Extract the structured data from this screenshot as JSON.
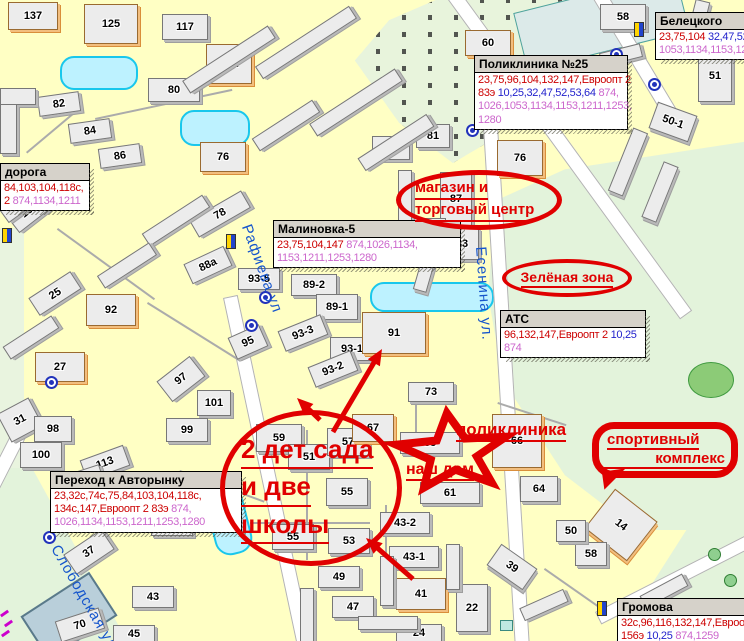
{
  "map": {
    "colors": {
      "route_red": "#CC0000",
      "route_blue": "#2222CC",
      "route_magenta": "#CC66CC",
      "annotation_red": "#E00000",
      "street_blue": "#1555CC"
    },
    "street_labels": [
      {
        "name": "street-rafieva",
        "text": "Рафиева ул",
        "x": 254,
        "y": 222,
        "rot": 70
      },
      {
        "name": "street-esenina",
        "text": "Есенина ул.",
        "x": 489,
        "y": 246,
        "rot": 86
      },
      {
        "name": "street-slobodskaya",
        "text": "Слободская ул",
        "x": 62,
        "y": 542,
        "rot": 60
      }
    ],
    "info_boxes": [
      {
        "title": "Белецкого",
        "x": 655,
        "y": 12,
        "w": 120,
        "lines": [
          [
            {
              "t": "23,75,104",
              "c": "r"
            },
            {
              "t": " 32,47,52,5",
              "c": "b"
            }
          ],
          [
            {
              "t": "1053,1134,1153,1211",
              "c": "m"
            }
          ]
        ]
      },
      {
        "title": "Поликлиника №25",
        "x": 474,
        "y": 55,
        "w": 152,
        "lines": [
          [
            {
              "t": "23,75,96,104,132,147,Евроопт 2",
              "c": "r"
            }
          ],
          [
            {
              "t": "83э",
              "c": "r"
            },
            {
              "t": " 10,25,32,47,52,53,64",
              "c": "b"
            },
            {
              "t": " 874,",
              "c": "m"
            }
          ],
          [
            {
              "t": "1026,1053,1134,1153,1211,1253,",
              "c": "m"
            }
          ],
          [
            {
              "t": "1280",
              "c": "m"
            }
          ]
        ]
      },
      {
        "title": "Малиновка-5",
        "x": 273,
        "y": 220,
        "w": 186,
        "lines": [
          [
            {
              "t": "23,75,104,147",
              "c": "r"
            },
            {
              "t": " 874,1026,1134,",
              "c": "m"
            }
          ],
          [
            {
              "t": "1153,1211,1253,1280",
              "c": "m"
            }
          ]
        ]
      },
      {
        "title": "АТС",
        "x": 500,
        "y": 310,
        "w": 144,
        "lines": [
          [
            {
              "t": "96,132,147,Евроопт 2",
              "c": "r"
            },
            {
              "t": " 10,25",
              "c": "b"
            }
          ],
          [
            {
              "t": "874",
              "c": "m"
            }
          ]
        ]
      },
      {
        "title": "дорога",
        "x": 0,
        "y": 163,
        "w": 88,
        "lines": [
          [
            {
              "t": "84,103,104,118с,",
              "c": "r"
            }
          ],
          [
            {
              "t": "2",
              "c": "r"
            },
            {
              "t": " 874,1134,1211",
              "c": "m"
            }
          ]
        ]
      },
      {
        "title": "Переход к Авторынку",
        "x": 50,
        "y": 471,
        "w": 190,
        "lines": [
          [
            {
              "t": "23,32с,74с,75,84,103,104,118с,",
              "c": "r"
            }
          ],
          [
            {
              "t": "134с,147,Евроопт 2  83э",
              "c": "r"
            },
            {
              "t": " 874,",
              "c": "m"
            }
          ],
          [
            {
              "t": "1026,1134,1153,1211,1253,1280",
              "c": "m"
            }
          ]
        ]
      },
      {
        "title": "Громова",
        "x": 617,
        "y": 598,
        "w": 130,
        "lines": [
          [
            {
              "t": "32с,96,116,132,147,Евроопт",
              "c": "r"
            }
          ],
          [
            {
              "t": "156э",
              "c": "r"
            },
            {
              "t": " 10,25",
              "c": "b"
            },
            {
              "t": " 874,1259",
              "c": "m"
            }
          ]
        ]
      }
    ],
    "annotations": {
      "ellipses": [
        {
          "name": "shop-area",
          "lines": [
            "магазин и",
            "торговый центр"
          ],
          "x": 396,
          "y": 170,
          "w": 166,
          "h": 60,
          "fs": 15,
          "pad": 14,
          "bw": 5,
          "center": false
        },
        {
          "name": "green-zone",
          "lines": [
            "Зелёная зона"
          ],
          "x": 502,
          "y": 259,
          "w": 130,
          "h": 38,
          "fs": 14,
          "pad": 0,
          "bw": 4,
          "center": true
        },
        {
          "name": "kindergartens-schools",
          "lines": [
            "2 дет сада",
            "и две",
            "школы"
          ],
          "x": 220,
          "y": 410,
          "w": 182,
          "h": 156,
          "fs": 26,
          "pad": 16,
          "bw": 5,
          "center": false
        }
      ],
      "labels": [
        {
          "name": "polyclinic",
          "text": "поликлиника",
          "x": 456,
          "y": 420,
          "fs": 17
        },
        {
          "name": "our-house",
          "text": "наш дом",
          "x": 406,
          "y": 460,
          "fs": 16
        }
      ],
      "bubble": {
        "name": "sports-complex",
        "lines": [
          "спортивный",
          "комплекс"
        ],
        "x": 592,
        "y": 422,
        "w": 146,
        "h": 56,
        "fs": 15
      },
      "star": {
        "cx": 453,
        "cy": 453,
        "rx": 58,
        "ry": 40,
        "inner": 0.42,
        "tilt": -6
      },
      "arrows": [
        {
          "x1": 333,
          "y1": 432,
          "x2": 382,
          "y2": 349
        },
        {
          "x1": 320,
          "y1": 420,
          "x2": 297,
          "y2": 398
        },
        {
          "x1": 413,
          "y1": 579,
          "x2": 366,
          "y2": 538
        }
      ]
    },
    "buildings": [
      {
        "l": "137",
        "x": 8,
        "y": 2,
        "w": 48,
        "h": 26,
        "o": 1
      },
      {
        "l": "125",
        "x": 84,
        "y": 4,
        "w": 52,
        "h": 38,
        "o": 1
      },
      {
        "l": "117",
        "x": 162,
        "y": 14,
        "w": 44,
        "h": 24
      },
      {
        "l": "82а",
        "x": 206,
        "y": 44,
        "w": 44,
        "h": 38,
        "o": 1
      },
      {
        "l": "80",
        "x": 148,
        "y": 78,
        "w": 50,
        "h": 22
      },
      {
        "l": "82",
        "x": 38,
        "y": 94,
        "w": 40,
        "h": 18,
        "r": -8
      },
      {
        "l": "84",
        "x": 69,
        "y": 121,
        "w": 40,
        "h": 18,
        "r": -8
      },
      {
        "l": "86",
        "x": 99,
        "y": 146,
        "w": 40,
        "h": 18,
        "r": -8
      },
      {
        "l": "76",
        "x": 200,
        "y": 142,
        "w": 44,
        "h": 28,
        "o": 1
      },
      {
        "l": "60",
        "x": 465,
        "y": 30,
        "w": 44,
        "h": 24,
        "o": 1
      },
      {
        "l": "58",
        "x": 600,
        "y": 4,
        "w": 44,
        "h": 24
      },
      {
        "l": "51",
        "x": 698,
        "y": 50,
        "w": 32,
        "h": 50
      },
      {
        "l": "50-1",
        "x": 652,
        "y": 108,
        "w": 40,
        "h": 26,
        "r": 20
      },
      {
        "l": "81",
        "x": 416,
        "y": 124,
        "w": 32,
        "h": 22
      },
      {
        "l": "81а",
        "x": 372,
        "y": 136,
        "w": 36,
        "h": 22
      },
      {
        "l": "76",
        "x": 497,
        "y": 140,
        "w": 44,
        "h": 34,
        "o": 1
      },
      {
        "l": "87",
        "x": 440,
        "y": 172,
        "w": 30,
        "h": 52
      },
      {
        "l": "85",
        "x": 412,
        "y": 218,
        "w": 32,
        "h": 22
      },
      {
        "l": "83",
        "x": 445,
        "y": 228,
        "w": 32,
        "h": 30
      },
      {
        "l": "78",
        "x": 190,
        "y": 204,
        "w": 58,
        "h": 18,
        "r": -30
      },
      {
        "l": "88а",
        "x": 186,
        "y": 254,
        "w": 42,
        "h": 20,
        "r": -25
      },
      {
        "l": "93-5",
        "x": 238,
        "y": 268,
        "w": 40,
        "h": 20
      },
      {
        "l": "89-2",
        "x": 291,
        "y": 274,
        "w": 44,
        "h": 20
      },
      {
        "l": "89-1",
        "x": 316,
        "y": 294,
        "w": 40,
        "h": 24
      },
      {
        "l": "93-3",
        "x": 280,
        "y": 322,
        "w": 44,
        "h": 20,
        "r": -22
      },
      {
        "l": "93-1",
        "x": 330,
        "y": 337,
        "w": 42,
        "h": 22
      },
      {
        "l": "93-2",
        "x": 310,
        "y": 358,
        "w": 44,
        "h": 20,
        "r": -22
      },
      {
        "l": "91",
        "x": 362,
        "y": 312,
        "w": 62,
        "h": 40,
        "o": 1
      },
      {
        "l": "95",
        "x": 231,
        "y": 330,
        "w": 32,
        "h": 22,
        "r": -24
      },
      {
        "l": "25",
        "x": 30,
        "y": 283,
        "w": 48,
        "h": 19,
        "r": -33
      },
      {
        "l": "92",
        "x": 86,
        "y": 294,
        "w": 48,
        "h": 30,
        "o": 1
      },
      {
        "l": "27",
        "x": 35,
        "y": 352,
        "w": 48,
        "h": 28,
        "o": 1
      },
      {
        "l": "31",
        "x": 2,
        "y": 404,
        "w": 34,
        "h": 30,
        "r": -28
      },
      {
        "l": "98",
        "x": 34,
        "y": 416,
        "w": 36,
        "h": 24
      },
      {
        "l": "100",
        "x": 20,
        "y": 442,
        "w": 40,
        "h": 24
      },
      {
        "l": "113",
        "x": 82,
        "y": 452,
        "w": 44,
        "h": 20,
        "r": -20
      },
      {
        "l": "97",
        "x": 160,
        "y": 366,
        "w": 40,
        "h": 24,
        "r": -38
      },
      {
        "l": "101",
        "x": 197,
        "y": 390,
        "w": 32,
        "h": 24
      },
      {
        "l": "99",
        "x": 166,
        "y": 418,
        "w": 40,
        "h": 22
      },
      {
        "l": "19",
        "x": 8,
        "y": 200,
        "w": 36,
        "h": 22,
        "r": -38
      },
      {
        "l": "37",
        "x": 66,
        "y": 540,
        "w": 44,
        "h": 22,
        "r": -34
      },
      {
        "l": "39",
        "x": 151,
        "y": 514,
        "w": 40,
        "h": 20
      },
      {
        "l": "43",
        "x": 132,
        "y": 586,
        "w": 40,
        "h": 20
      },
      {
        "l": "45",
        "x": 113,
        "y": 625,
        "w": 40,
        "h": 16
      },
      {
        "l": "70",
        "x": 57,
        "y": 614,
        "w": 44,
        "h": 20,
        "r": -18
      },
      {
        "l": "59",
        "x": 256,
        "y": 424,
        "w": 44,
        "h": 26
      },
      {
        "l": "51",
        "x": 288,
        "y": 444,
        "w": 40,
        "h": 24
      },
      {
        "l": "57",
        "x": 327,
        "y": 428,
        "w": 40,
        "h": 26
      },
      {
        "l": "55",
        "x": 326,
        "y": 478,
        "w": 40,
        "h": 26
      },
      {
        "l": "55",
        "x": 272,
        "y": 524,
        "w": 40,
        "h": 24
      },
      {
        "l": "53",
        "x": 328,
        "y": 528,
        "w": 40,
        "h": 24
      },
      {
        "l": "67",
        "x": 352,
        "y": 414,
        "w": 40,
        "h": 26,
        "o": 1
      },
      {
        "l": "73",
        "x": 408,
        "y": 382,
        "w": 44,
        "h": 18
      },
      {
        "l": "63",
        "x": 400,
        "y": 432,
        "w": 58,
        "h": 20
      },
      {
        "l": "61",
        "x": 420,
        "y": 482,
        "w": 58,
        "h": 20
      },
      {
        "l": "66",
        "x": 492,
        "y": 414,
        "w": 48,
        "h": 52,
        "o": 1
      },
      {
        "l": "64",
        "x": 520,
        "y": 476,
        "w": 36,
        "h": 24
      },
      {
        "l": "43-2",
        "x": 380,
        "y": 512,
        "w": 48,
        "h": 20
      },
      {
        "l": "43-1",
        "x": 389,
        "y": 546,
        "w": 48,
        "h": 20
      },
      {
        "l": "41",
        "x": 396,
        "y": 578,
        "w": 48,
        "h": 30,
        "o": 1
      },
      {
        "l": "49",
        "x": 318,
        "y": 566,
        "w": 40,
        "h": 20
      },
      {
        "l": "47",
        "x": 332,
        "y": 596,
        "w": 40,
        "h": 20
      },
      {
        "l": "24",
        "x": 396,
        "y": 624,
        "w": 44,
        "h": 16
      },
      {
        "l": "22",
        "x": 456,
        "y": 584,
        "w": 30,
        "h": 46
      },
      {
        "l": "39",
        "x": 490,
        "y": 554,
        "w": 42,
        "h": 24,
        "r": 35
      },
      {
        "l": "14",
        "x": 594,
        "y": 500,
        "w": 52,
        "h": 48,
        "r": 38,
        "o": 1
      },
      {
        "l": "58",
        "x": 575,
        "y": 542,
        "w": 30,
        "h": 22
      },
      {
        "l": "50",
        "x": 556,
        "y": 520,
        "w": 28,
        "h": 20
      },
      {
        "x": 250,
        "y": 35,
        "w": 110,
        "h": 13,
        "r": -33
      },
      {
        "x": 178,
        "y": 52,
        "w": 100,
        "h": 13,
        "r": -33
      },
      {
        "x": 305,
        "y": 95,
        "w": 100,
        "h": 13,
        "r": -33
      },
      {
        "x": 355,
        "y": 135,
        "w": 80,
        "h": 13,
        "r": -33
      },
      {
        "x": 250,
        "y": 118,
        "w": 70,
        "h": 13,
        "r": -33
      },
      {
        "x": 398,
        "y": 170,
        "w": 12,
        "h": 50
      },
      {
        "x": 420,
        "y": 238,
        "w": 12,
        "h": 52,
        "r": 16
      },
      {
        "x": 0,
        "y": 88,
        "w": 34,
        "h": 15
      },
      {
        "x": 0,
        "y": 104,
        "w": 15,
        "h": 48
      },
      {
        "x": 140,
        "y": 213,
        "w": 70,
        "h": 13,
        "r": -33
      },
      {
        "x": 96,
        "y": 258,
        "w": 60,
        "h": 13,
        "r": -33
      },
      {
        "x": 2,
        "y": 330,
        "w": 56,
        "h": 13,
        "r": -33
      },
      {
        "x": 620,
        "y": 128,
        "w": 14,
        "h": 66,
        "r": 22
      },
      {
        "x": 652,
        "y": 162,
        "w": 14,
        "h": 58,
        "r": 22
      },
      {
        "x": 380,
        "y": 556,
        "w": 12,
        "h": 48
      },
      {
        "x": 300,
        "y": 588,
        "w": 12,
        "h": 52
      },
      {
        "x": 358,
        "y": 616,
        "w": 58,
        "h": 12
      },
      {
        "x": 446,
        "y": 544,
        "w": 12,
        "h": 44
      },
      {
        "x": 520,
        "y": 598,
        "w": 46,
        "h": 12,
        "r": -24
      },
      {
        "x": 640,
        "y": 584,
        "w": 46,
        "h": 12,
        "r": -28
      },
      {
        "x": 0,
        "y": 196,
        "w": 44,
        "h": 13,
        "r": -36
      },
      {
        "x": 690,
        "y": 0,
        "w": 13,
        "h": 44,
        "r": 14
      },
      {
        "x": 600,
        "y": 48,
        "w": 40,
        "h": 12,
        "r": -14
      },
      {
        "x": 62,
        "y": 470,
        "w": 38,
        "h": 12,
        "r": -18
      }
    ],
    "bus_stops": [
      [
        610,
        48
      ],
      [
        648,
        78
      ],
      [
        466,
        124
      ],
      [
        259,
        291
      ],
      [
        245,
        319
      ],
      [
        43,
        531
      ],
      [
        45,
        376
      ]
    ],
    "bus_shelters": [
      [
        634,
        22
      ],
      [
        226,
        234
      ],
      [
        597,
        601
      ],
      [
        2,
        228
      ]
    ],
    "trees": [
      [
        708,
        548
      ],
      [
        724,
        574
      ]
    ],
    "tram_dashes": [
      [
        0,
        612
      ],
      [
        4,
        622
      ],
      [
        1,
        632
      ]
    ]
  }
}
